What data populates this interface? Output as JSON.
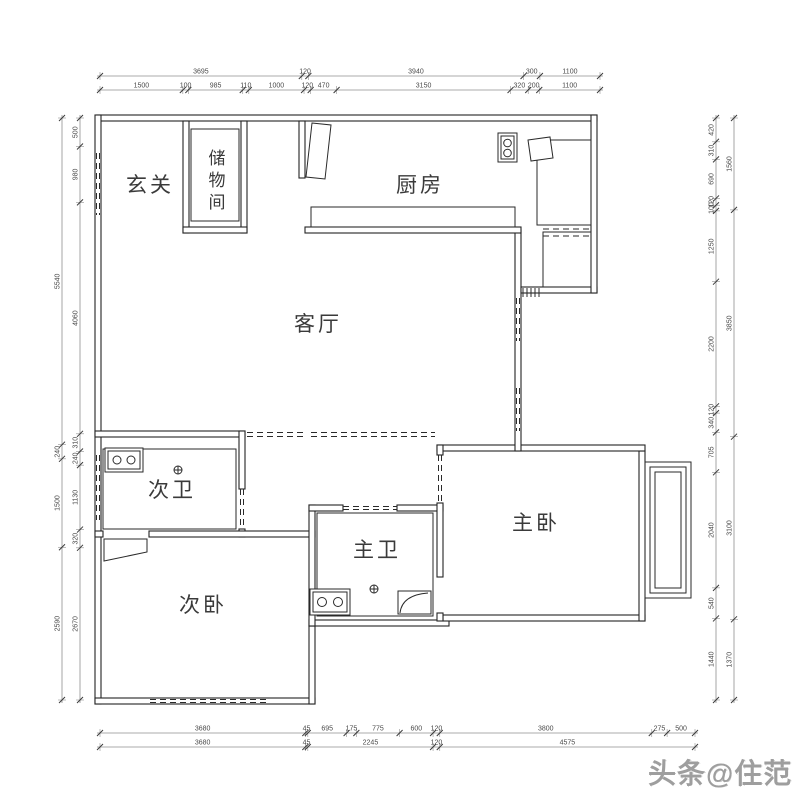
{
  "watermark": "头条@住范儿",
  "rooms": {
    "entry": {
      "label": "玄关"
    },
    "storage": {
      "label": "储物间"
    },
    "kitchen": {
      "label": "厨房"
    },
    "living": {
      "label": "客厅"
    },
    "bath2": {
      "label": "次卫"
    },
    "bed2": {
      "label": "次卧"
    },
    "bath1": {
      "label": "主卫"
    },
    "bed1": {
      "label": "主卧"
    }
  },
  "colors": {
    "wall_line": "#242424",
    "dimension_line": "#8f8f8f",
    "dimension_text": "#4a4a4a",
    "watermark_gray": "#9e9e9e"
  },
  "dimensions": {
    "rows": [
      {
        "id": "top-outer",
        "orient": "h",
        "line": 76,
        "from": 100,
        "to": 600,
        "values": [
          "3695",
          "120",
          "3940",
          "300",
          "1100"
        ]
      },
      {
        "id": "top-inner",
        "orient": "h",
        "line": 90,
        "from": 100,
        "to": 600,
        "values": [
          "1500",
          "100",
          "985",
          "110",
          "1000",
          "120",
          "470",
          "3150",
          "320",
          "200",
          "1100"
        ]
      },
      {
        "id": "bottom-inner",
        "orient": "h",
        "line": 733,
        "from": 100,
        "to": 695,
        "values": [
          "3680",
          "45",
          "695",
          "175",
          "775",
          "600",
          "120",
          "3800",
          "275",
          "500"
        ]
      },
      {
        "id": "bottom-outer",
        "orient": "h",
        "line": 747,
        "from": 100,
        "to": 695,
        "values": [
          "3680",
          "45",
          "2245",
          "120",
          "4575"
        ]
      },
      {
        "id": "left-outer",
        "orient": "v",
        "line": 62,
        "from": 118,
        "to": 700,
        "values": [
          "5540",
          "240",
          "1500",
          "2590"
        ]
      },
      {
        "id": "left-inner",
        "orient": "v",
        "line": 80,
        "from": 118,
        "to": 700,
        "values": [
          "500",
          "980",
          "4060",
          "310",
          "240",
          "1130",
          "320",
          "2670"
        ]
      },
      {
        "id": "right-inner",
        "orient": "v",
        "line": 716,
        "from": 118,
        "to": 700,
        "values": [
          "420",
          "310",
          "690",
          "120",
          "100",
          "1250",
          "2200",
          "120",
          "340",
          "705",
          "2040",
          "540",
          "1440"
        ]
      },
      {
        "id": "right-outer",
        "orient": "v",
        "line": 734,
        "from": 118,
        "to": 700,
        "values": [
          "1560",
          "3850",
          "3100",
          "1370"
        ]
      }
    ]
  }
}
